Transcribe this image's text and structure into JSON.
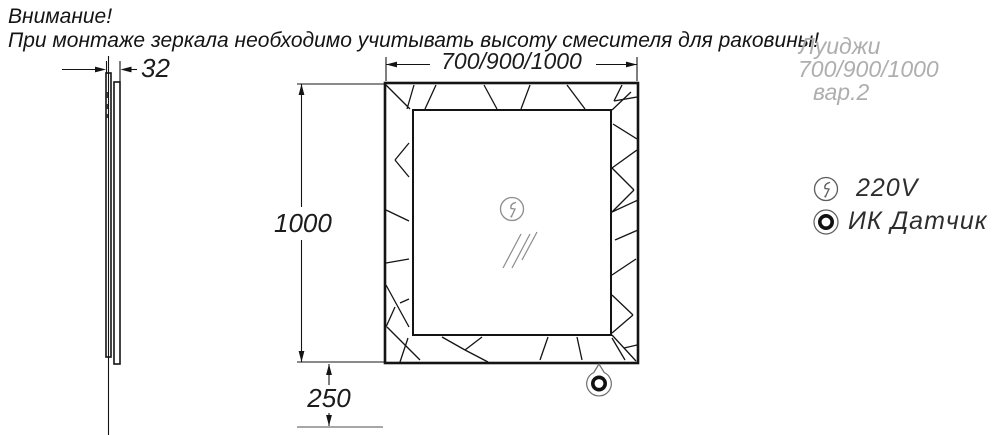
{
  "warning": {
    "line1": "Внимание!",
    "line2": "При монтаже зеркала необходимо учитывать высоту смесителя для раковины!"
  },
  "title_block": {
    "model": "Луиджи",
    "sizes": "700/900/1000",
    "variant": "вар.2"
  },
  "dimensions": {
    "depth_mm": "32",
    "width_mm": "700/900/1000",
    "height_mm": "1000",
    "bottom_offset_mm": "250"
  },
  "legend": [
    {
      "icon": "power-circle-icon",
      "label": "220V"
    },
    {
      "icon": "ir-sensor-icon",
      "label": "ИК Датчик"
    }
  ],
  "colors": {
    "line": "#141414",
    "muted_gray": "#8c8c8c",
    "title_gray": "#aeaeae",
    "reference_line": "#8a8a8a"
  }
}
